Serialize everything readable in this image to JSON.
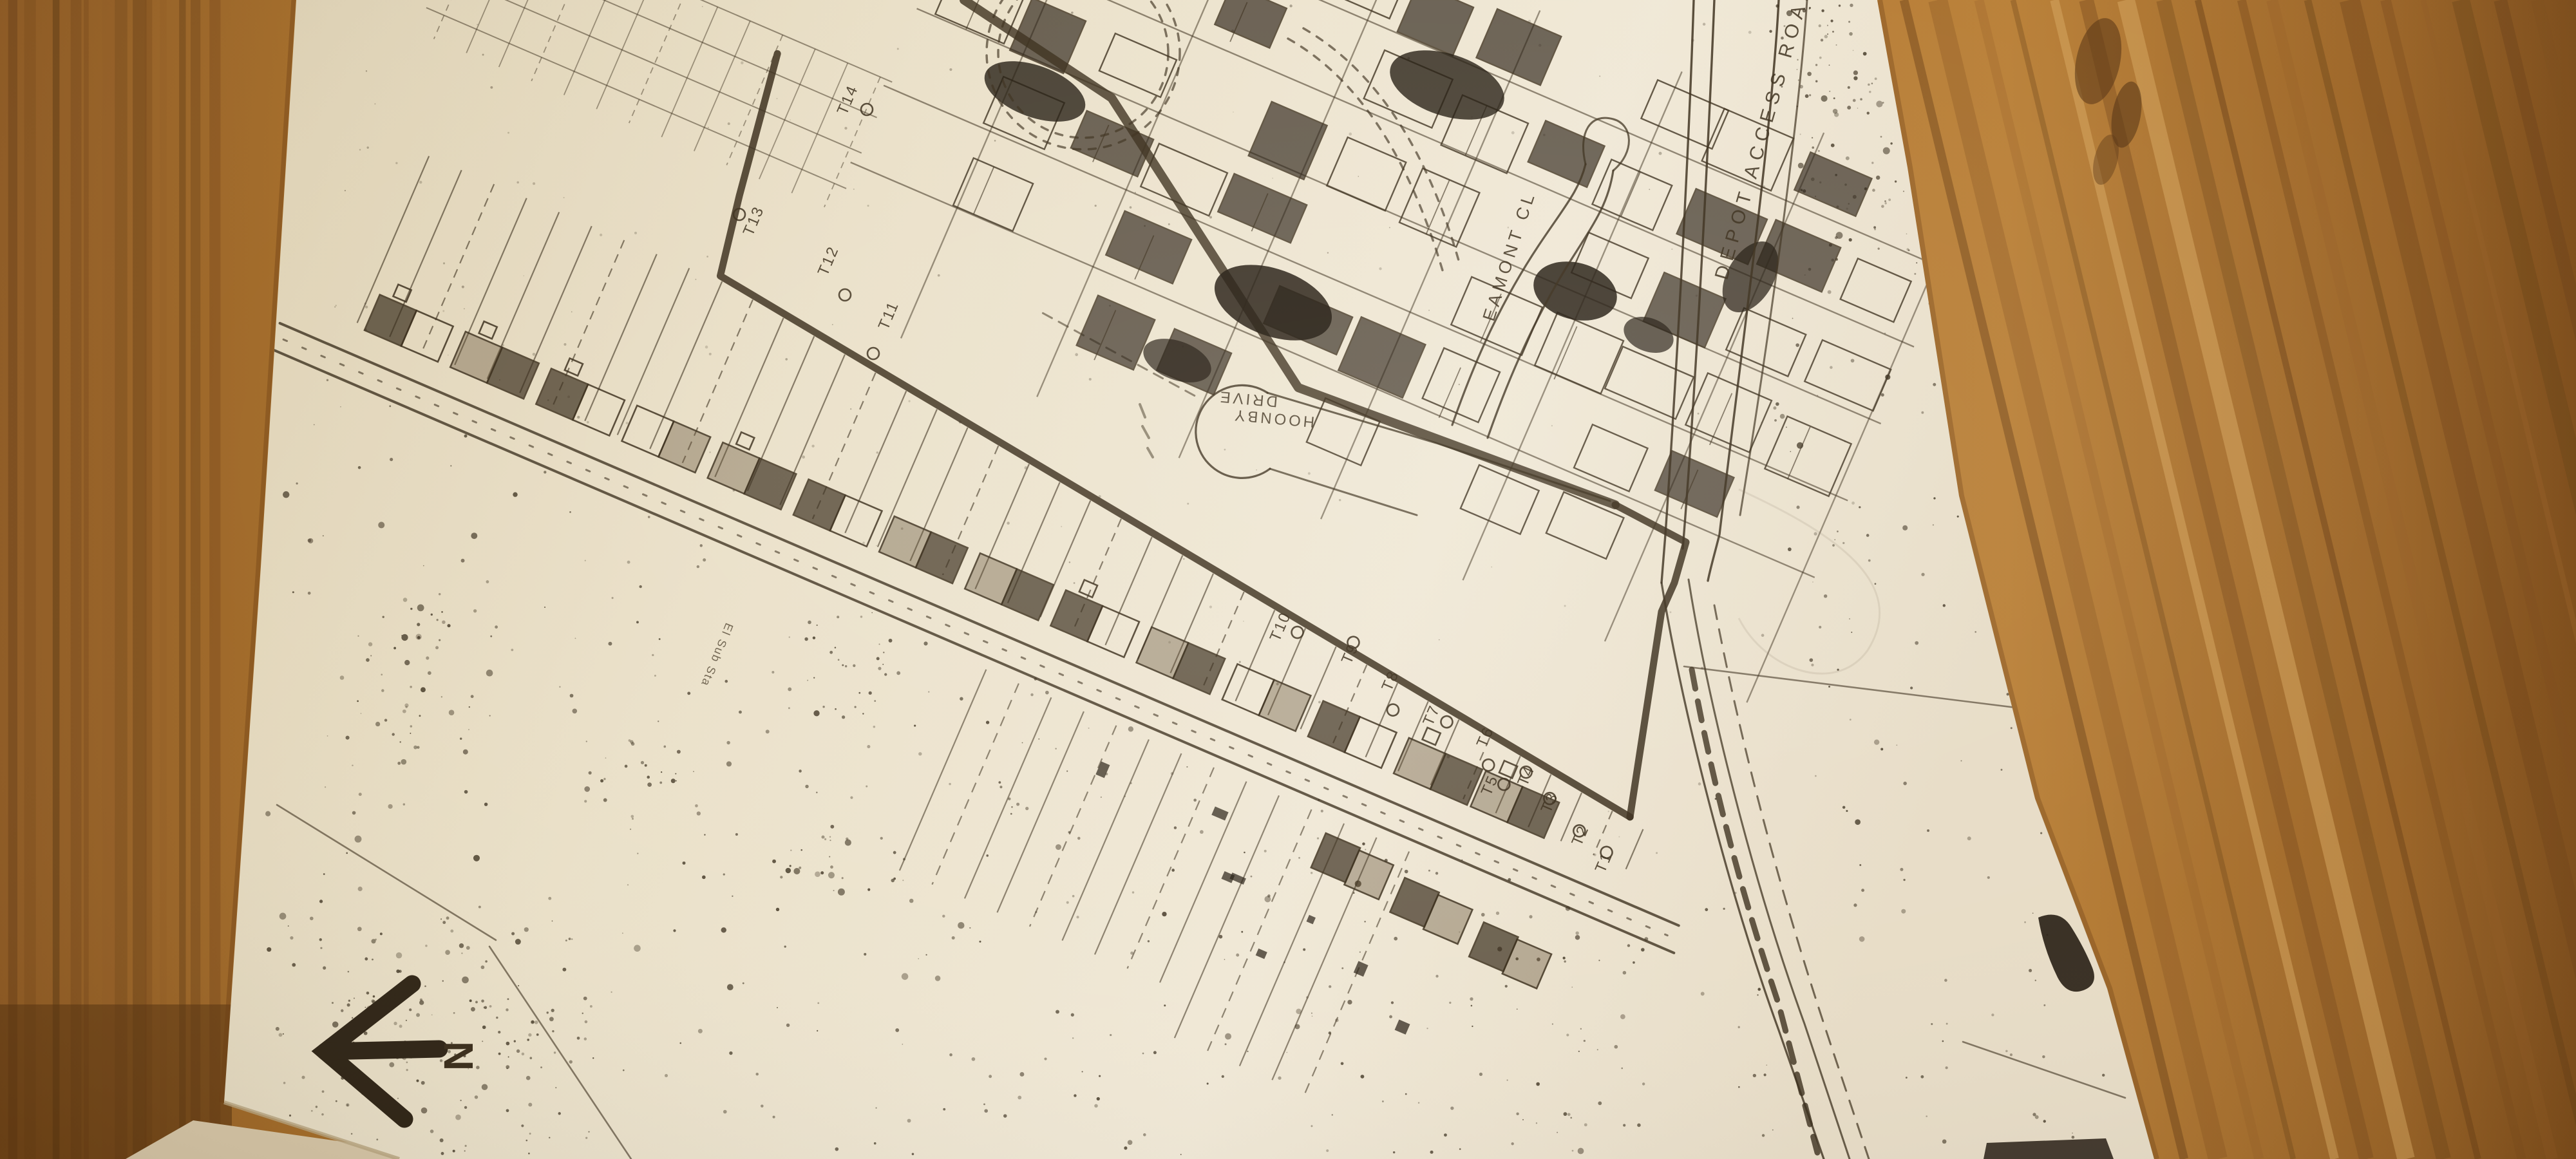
{
  "map": {
    "street_labels": {
      "depot_access_road": "DEPOT ACCESS ROAD",
      "eamont_close": "EAMONT CL",
      "drive_line1": "DRIVE",
      "drive_line2": "HOONBY"
    },
    "substation_label": "El Sub Sta",
    "north_label": "N",
    "tree_labels": [
      "T1",
      "T2",
      "T3",
      "T4",
      "T5",
      "T6",
      "T7",
      "T8",
      "T9",
      "T10",
      "T11",
      "T12",
      "T13",
      "T14"
    ]
  }
}
